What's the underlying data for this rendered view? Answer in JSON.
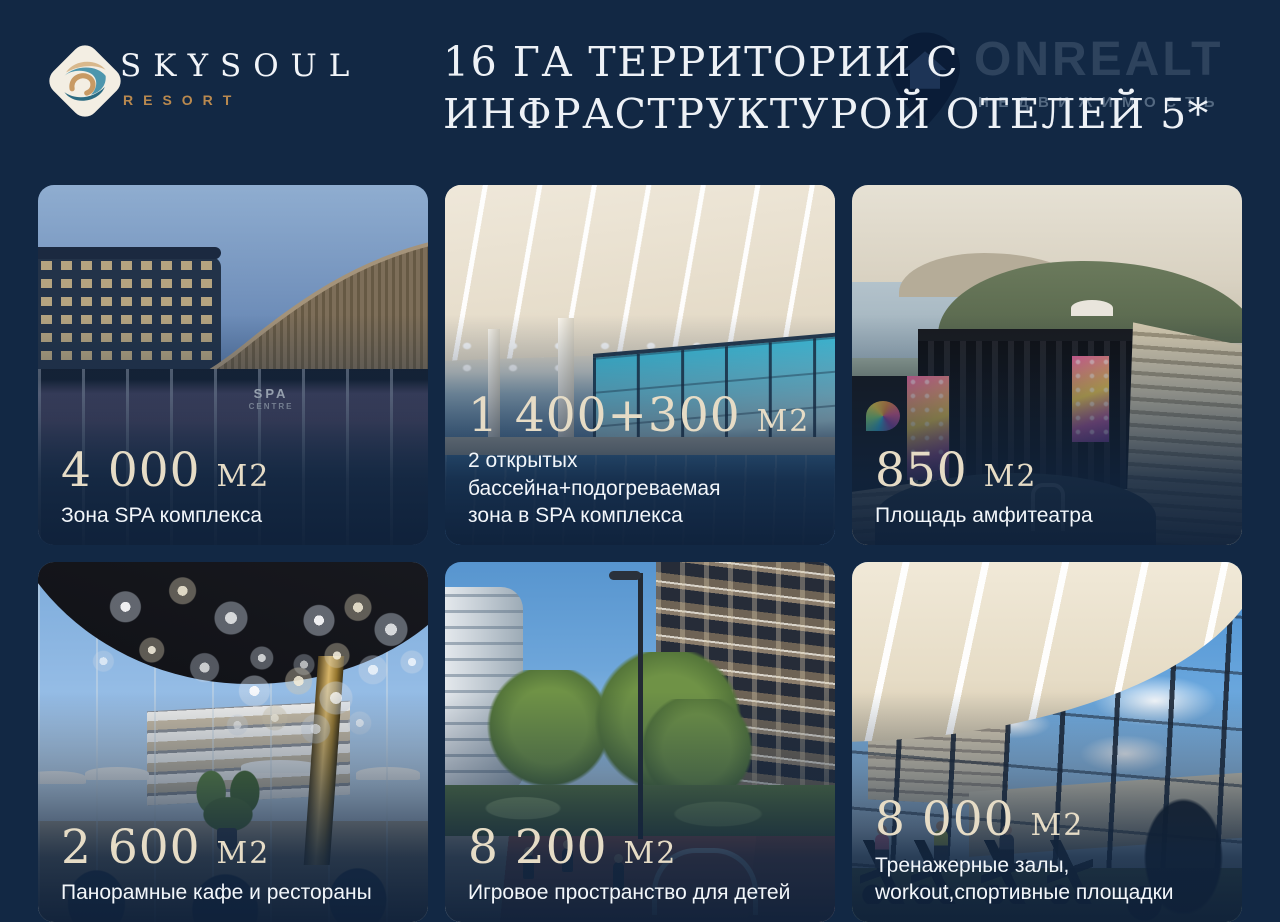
{
  "page": {
    "background": "#122844"
  },
  "logo": {
    "brand": "SKYSOUL",
    "subtitle": "RESORT"
  },
  "title": {
    "line1": "16 ГА ТЕРРИТОРИИ С",
    "line2": "ИНФРАСТРУКТУРОЙ ОТЕЛЕЙ 5*"
  },
  "watermark": {
    "brand": "ONREALT",
    "tagline": "НЕДВИЖИМОСТЬ",
    "icon": "location-pin-house-icon"
  },
  "colors": {
    "accent_cream": "#e6dcc6",
    "accent_tan": "#b9894f",
    "text_white": "#f2f6fa",
    "navy_background": "#122844"
  },
  "cards": [
    {
      "value": "4 000",
      "unit": "М2",
      "caption_lines": [
        "Зона SPA комплекса"
      ],
      "photo": "spa-complex-exterior",
      "sign_lines": [
        "SPA",
        "CENTRE"
      ]
    },
    {
      "value": "1 400+300",
      "unit": "М2",
      "caption_lines": [
        "2 открытых бассейна+подогреваемая",
        "зона в SPA комплекса"
      ],
      "photo": "indoor-pool"
    },
    {
      "value": "850",
      "unit": "М2",
      "caption_lines": [
        "Площадь амфитеатра"
      ],
      "photo": "amphitheater"
    },
    {
      "value": "2 600",
      "unit": "М2",
      "caption_lines": [
        "Панорамные кафе и рестораны"
      ],
      "photo": "panoramic-cafe"
    },
    {
      "value": "8 200",
      "unit": "М2",
      "caption_lines": [
        "Игровое пространство для детей"
      ],
      "photo": "kids-playground"
    },
    {
      "value": "8 000",
      "unit": "М2",
      "caption_lines": [
        "Тренажерные залы,",
        "workout,спортивные площадки"
      ],
      "photo": "gym-workout"
    }
  ]
}
